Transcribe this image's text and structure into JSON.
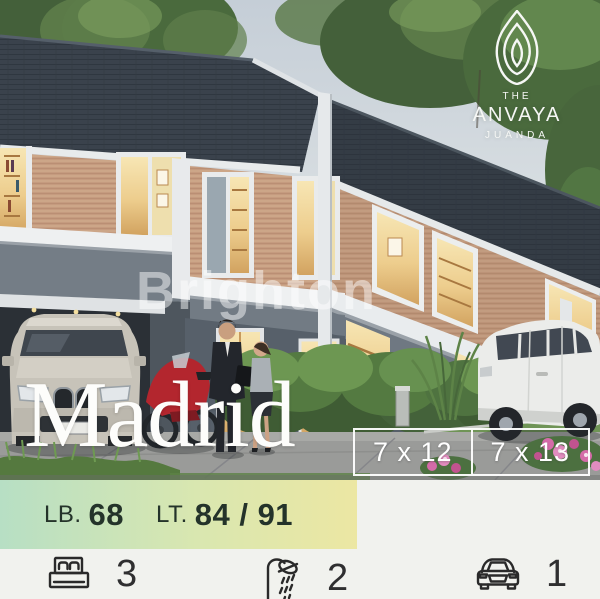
{
  "branding": {
    "logo_top": "THE",
    "logo_name": "ANVAYA",
    "logo_sub": "JUANDA"
  },
  "watermark": "Brighton",
  "listing": {
    "title": "Madrid",
    "dimensions": [
      {
        "label": "7 x 12"
      },
      {
        "label": "7 x 13"
      }
    ],
    "specs": {
      "lb_label": "LB.",
      "lb_value": "68",
      "lt_label": "LT.",
      "lt_value": "84 / 91"
    },
    "features": [
      {
        "name": "bedrooms",
        "icon": "bed-icon",
        "count": "3"
      },
      {
        "name": "bathrooms",
        "icon": "shower-icon",
        "count": "2"
      },
      {
        "name": "carport",
        "icon": "car-icon",
        "count": "1"
      }
    ]
  },
  "palette": {
    "strip_green": "#b7dfc4",
    "strip_yellow": "#ece7a3",
    "spec_text": "#24332a",
    "roof": "#39414b",
    "wood_wall": "#c59b7f",
    "overlay_white": "#ffffff",
    "bottom_bg": "#f1f2ee"
  }
}
